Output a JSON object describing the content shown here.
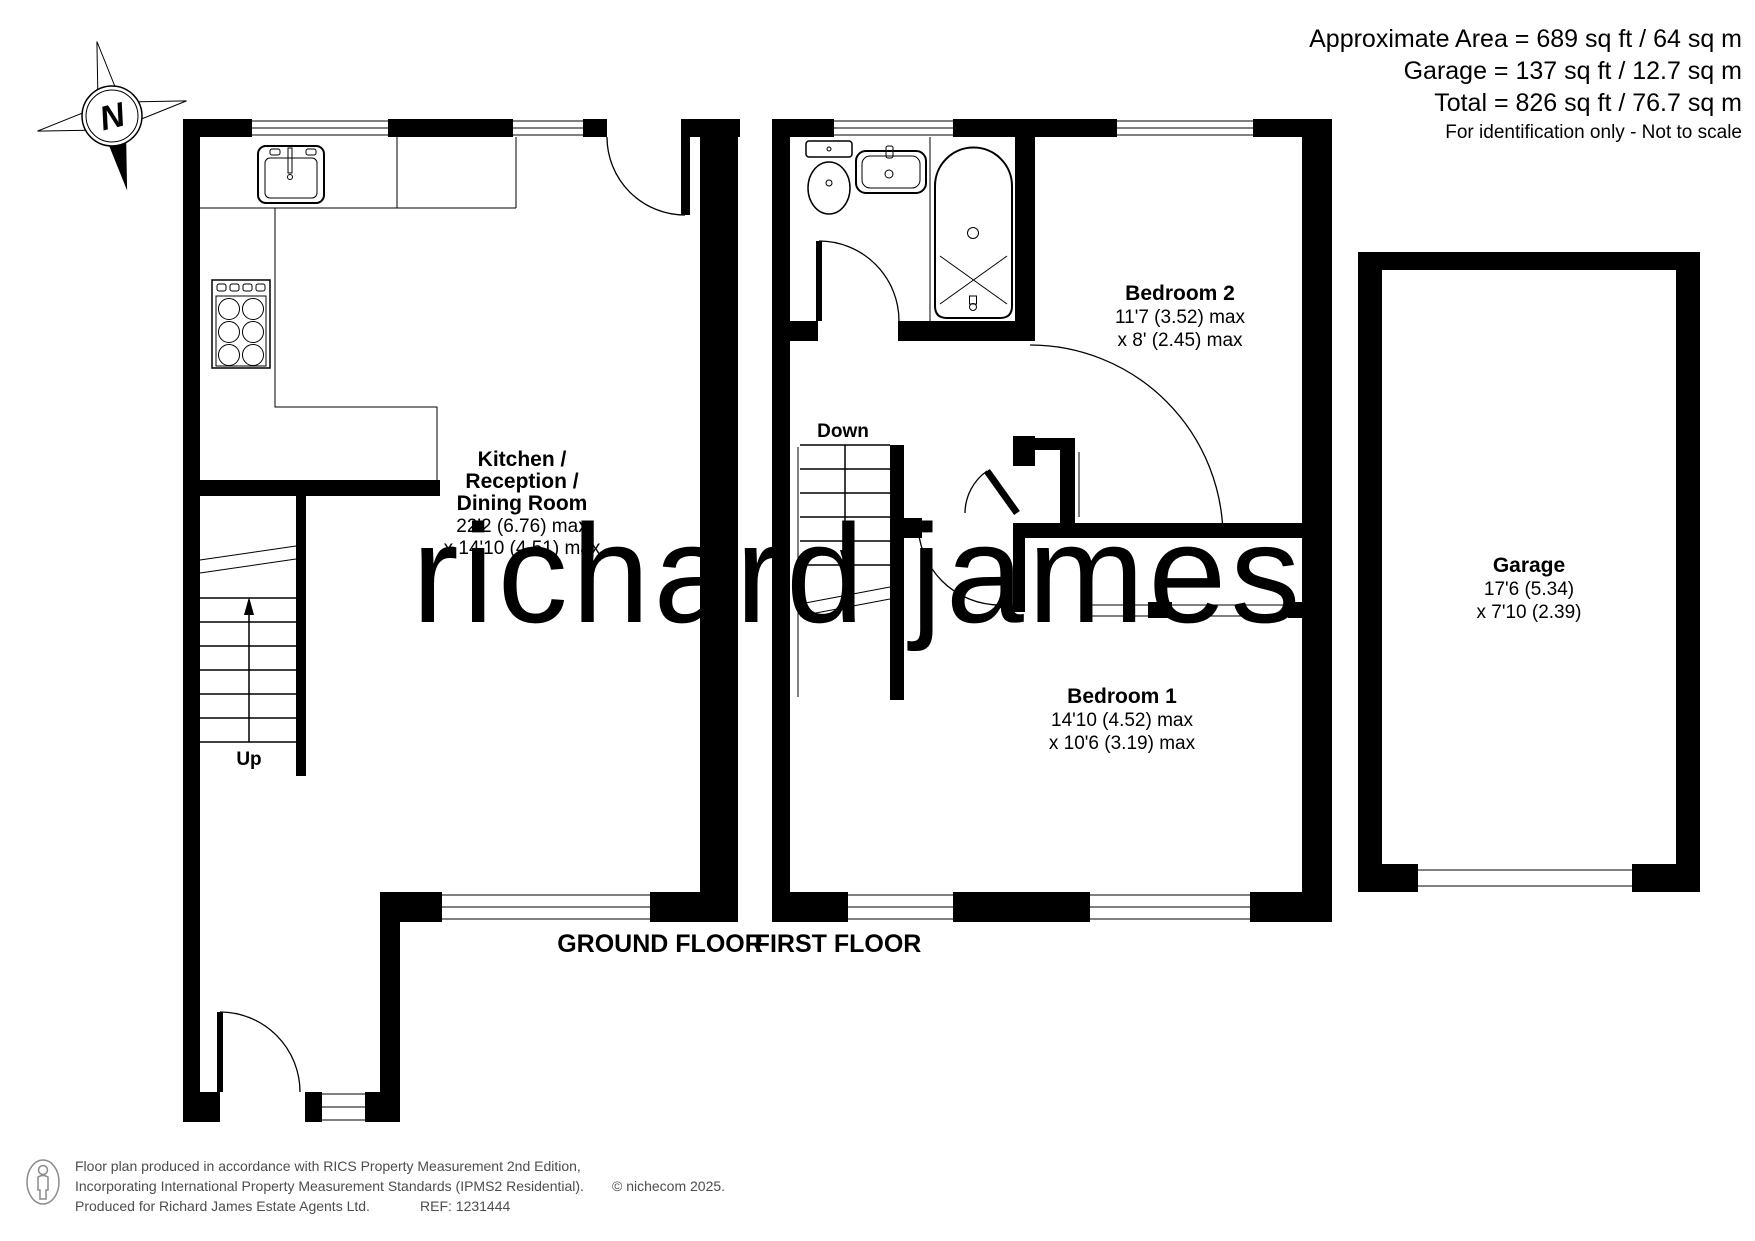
{
  "header": {
    "approximate_area": "Approximate Area = 689 sq ft / 64 sq m",
    "garage_area": "Garage = 137 sq ft / 12.7 sq m",
    "total_area": "Total = 826 sq ft / 76.7 sq m",
    "disclaimer": "For identification only - Not to scale"
  },
  "compass": {
    "north_label": "N"
  },
  "watermark": {
    "text": "richard james"
  },
  "ground_floor": {
    "label": "GROUND FLOOR",
    "stairs_label": "Up",
    "kitchen": {
      "name_line1": "Kitchen /",
      "name_line2": "Reception /",
      "name_line3": "Dining Room",
      "dims_line1": "22'2 (6.76) max",
      "dims_line2": "x 14'10 (4.51) max"
    }
  },
  "first_floor": {
    "label": "FIRST FLOOR",
    "stairs_label": "Down",
    "bedroom2": {
      "name": "Bedroom 2",
      "dims_line1": "11'7 (3.52) max",
      "dims_line2": "x 8' (2.45) max"
    },
    "bedroom1": {
      "name": "Bedroom 1",
      "dims_line1": "14'10 (4.52) max",
      "dims_line2": "x 10'6 (3.19) max"
    }
  },
  "garage": {
    "name": "Garage",
    "dims_line1": "17'6 (5.34)",
    "dims_line2": "x 7'10 (2.39)"
  },
  "footer": {
    "line1": "Floor plan produced in accordance with RICS Property Measurement 2nd Edition,",
    "line2": "Incorporating International Property Measurement Standards (IPMS2 Residential).",
    "copyright": "© nichecom 2025.",
    "line3": "Produced for Richard James Estate Agents Ltd.",
    "reference": "REF: 1231444"
  },
  "colors": {
    "wall": "#000000",
    "watermark": "#eed8ad",
    "footer_text": "#4d4d4d"
  }
}
